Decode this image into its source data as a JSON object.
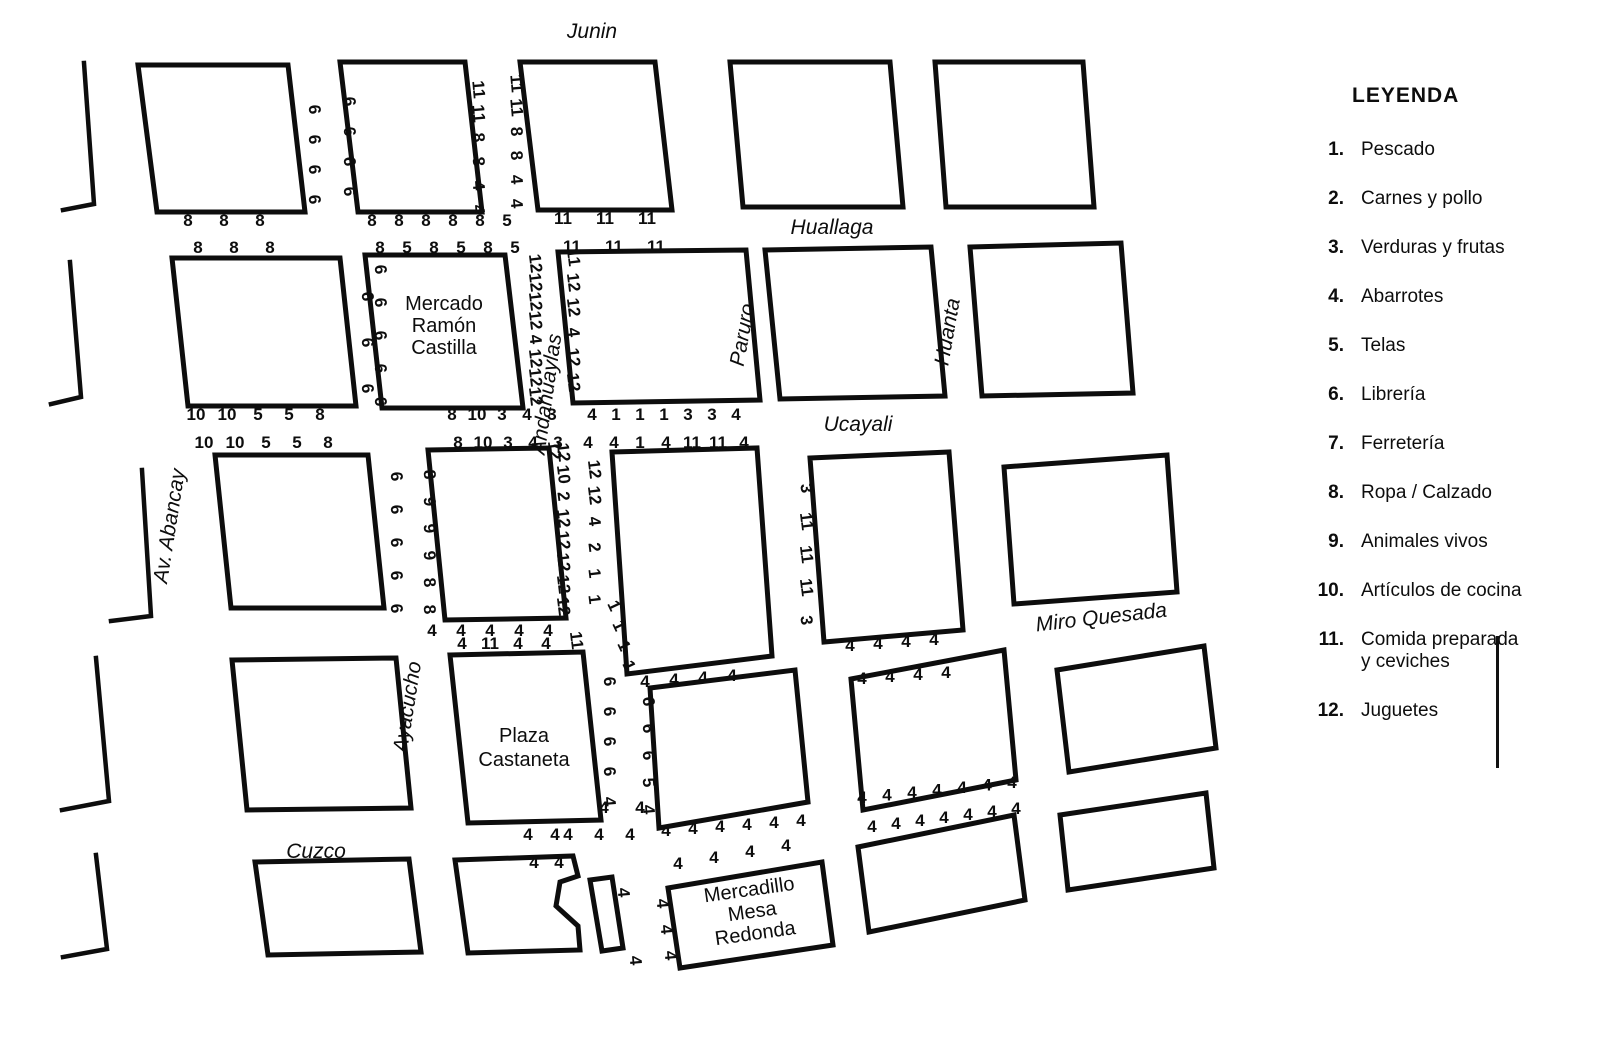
{
  "legend": {
    "title": "LEYENDA",
    "items": [
      {
        "num": "1.",
        "label": "Pescado"
      },
      {
        "num": "2.",
        "label": "Carnes y pollo"
      },
      {
        "num": "3.",
        "label": "Verduras y frutas"
      },
      {
        "num": "4.",
        "label": "Abarrotes"
      },
      {
        "num": "5.",
        "label": "Telas"
      },
      {
        "num": "6.",
        "label": "Librería"
      },
      {
        "num": "7.",
        "label": "Ferretería"
      },
      {
        "num": "8.",
        "label": "Ropa / Calzado"
      },
      {
        "num": "9.",
        "label": "Animales vivos"
      },
      {
        "num": "10.",
        "label": "Artículos de cocina"
      },
      {
        "num": "11.",
        "label": "Comida preparada\ny ceviches"
      },
      {
        "num": "12.",
        "label": "Juguetes"
      }
    ]
  },
  "map": {
    "street_labels": [
      {
        "name": "street-junin",
        "text": "Junin",
        "x": 592,
        "y": 38,
        "rot": 0
      },
      {
        "name": "street-huallaga",
        "text": "Huallaga",
        "x": 832,
        "y": 234,
        "rot": 0
      },
      {
        "name": "street-ucayali",
        "text": "Ucayali",
        "x": 858,
        "y": 431,
        "rot": 0
      },
      {
        "name": "street-miro-quesada",
        "text": "Miro Quesada",
        "x": 1102,
        "y": 624,
        "rot": -6.5
      },
      {
        "name": "street-cuzco",
        "text": "Cuzco",
        "x": 316,
        "y": 858,
        "rot": 0
      },
      {
        "name": "street-av-abancay",
        "text": "Av.  Abancay",
        "x": 176,
        "y": 527,
        "rot": -81
      },
      {
        "name": "street-ayacucho",
        "text": "Ayacucho",
        "x": 414,
        "y": 708,
        "rot": -81
      },
      {
        "name": "street-andahuaylas",
        "text": "Andahuaylas",
        "x": 553,
        "y": 395,
        "rot": -82
      },
      {
        "name": "street-paruro",
        "text": "Paruro",
        "x": 749,
        "y": 336,
        "rot": -80
      },
      {
        "name": "street-huanta",
        "text": "Huanta",
        "x": 954,
        "y": 333,
        "rot": -80
      }
    ],
    "block_labels": [
      {
        "name": "label-mercado-ramon-castilla",
        "lines": [
          "Mercado",
          "Ramón",
          "Castilla"
        ],
        "x": 444,
        "y": 310,
        "lh": 22,
        "rot": 0
      },
      {
        "name": "label-plaza-castaneta",
        "lines": [
          "Plaza",
          "Castaneta"
        ],
        "x": 524,
        "y": 742,
        "lh": 24,
        "rot": 0
      },
      {
        "name": "label-mercadillo-mesa-redonda",
        "lines": [
          "Mercadillo",
          "Mesa",
          "Redonda"
        ],
        "x": 750,
        "y": 896,
        "lh": 22,
        "rot": -8
      }
    ],
    "blocks": [
      {
        "name": "block-r1c1",
        "points": "138,65 288,65 305,212 157,212"
      },
      {
        "name": "block-r1c2",
        "points": "340,62 465,62 482,212 358,212"
      },
      {
        "name": "block-r1c3",
        "points": "520,62 655,62 672,210 538,210"
      },
      {
        "name": "block-r1c4",
        "points": "730,62 890,62 903,207 743,207"
      },
      {
        "name": "block-r1c5",
        "points": "935,62 1083,62 1094,207 946,207"
      },
      {
        "name": "block-r2c1",
        "points": "172,258 340,258 356,406 188,406"
      },
      {
        "name": "block-mercado-ramon-castilla",
        "points": "365,255 505,255 523,408 382,408"
      },
      {
        "name": "block-r2c3",
        "points": "558,252 746,250 760,400 573,403"
      },
      {
        "name": "block-r2c4",
        "points": "765,250 931,247 945,396 780,399"
      },
      {
        "name": "block-r2c5",
        "points": "970,247 1121,243 1133,393 982,396"
      },
      {
        "name": "block-r3c1",
        "points": "215,455 368,455 384,608 231,608"
      },
      {
        "name": "block-r3c2",
        "points": "428,450 549,448 566,618 445,620"
      },
      {
        "name": "block-r3c3",
        "points": "612,452 757,448 772,656 627,674"
      },
      {
        "name": "block-r3c4",
        "points": "810,458 949,452 963,630 824,642"
      },
      {
        "name": "block-r3c5",
        "points": "1004,467 1167,455 1177,592 1014,604"
      },
      {
        "name": "block-r4c1",
        "points": "232,660 396,658 411,808 247,810"
      },
      {
        "name": "block-plaza-castaneta",
        "points": "450,655 583,652 601,820 468,823"
      },
      {
        "name": "block-r4c3",
        "points": "650,688 795,670 808,802 659,828"
      },
      {
        "name": "block-r4c4",
        "points": "851,679 1004,650 1016,780 863,810"
      },
      {
        "name": "block-r4c5",
        "points": "1057,670 1204,646 1216,748 1069,772"
      },
      {
        "name": "block-r5c1",
        "points": "255,862 409,859 421,952 268,955"
      },
      {
        "name": "block-r5c2-notched",
        "points": "455,860 573,856 578,876 560,882 556,906 578,926 580,950 468,953"
      },
      {
        "name": "block-sliver",
        "points": "590,880 612,877 623,948 602,951"
      },
      {
        "name": "block-mercadillo-mesa-redonda",
        "points": "668,888 822,862 833,945 680,968"
      },
      {
        "name": "block-r5c4",
        "points": "858,847 1014,815 1025,900 869,932"
      },
      {
        "name": "block-r5c5",
        "points": "1060,815 1206,793 1214,868 1068,890"
      }
    ],
    "edge_lines": [
      {
        "name": "edge-r1-left",
        "d": "M 84,63 L 94,204 L 63,210"
      },
      {
        "name": "edge-r2-left",
        "d": "M 70,262 L 81,397 L 51,404"
      },
      {
        "name": "edge-r3-left",
        "d": "M 142,470 L 151,616 L 111,621"
      },
      {
        "name": "edge-r4-left",
        "d": "M 96,658 L 109,801 L 62,810"
      },
      {
        "name": "edge-r5-left",
        "d": "M 96,855 L 107,949 L 63,957"
      }
    ],
    "stalls": [
      {
        "values": [
          "8",
          "8",
          "8"
        ],
        "x": 188,
        "y": 226,
        "dx": 36
      },
      {
        "values": [
          "8",
          "8",
          "8"
        ],
        "x": 198,
        "y": 253,
        "dx": 36
      },
      {
        "values": [
          "8",
          "8",
          "8",
          "8",
          "8",
          "5"
        ],
        "x": 372,
        "y": 226,
        "dx": 27
      },
      {
        "values": [
          "8",
          "5",
          "8",
          "5",
          "8",
          "5"
        ],
        "x": 380,
        "y": 253,
        "dx": 27
      },
      {
        "values": [
          "11",
          "11",
          "11"
        ],
        "x": 563,
        "y": 224,
        "dx": 42
      },
      {
        "values": [
          "11",
          "11",
          "11"
        ],
        "x": 572,
        "y": 252,
        "dx": 42
      },
      {
        "values": [
          "10",
          "10",
          "5",
          "5",
          "8"
        ],
        "x": 196,
        "y": 420,
        "dx": 31
      },
      {
        "values": [
          "10",
          "10",
          "5",
          "5",
          "8"
        ],
        "x": 204,
        "y": 448,
        "dx": 31
      },
      {
        "values": [
          "8",
          "10",
          "3",
          "4",
          "3"
        ],
        "x": 452,
        "y": 420,
        "dx": 25
      },
      {
        "values": [
          "8",
          "10",
          "3",
          "4",
          "3"
        ],
        "x": 458,
        "y": 448,
        "dx": 25
      },
      {
        "values": [
          "4",
          "1",
          "1",
          "1",
          "3",
          "3",
          "4"
        ],
        "x": 592,
        "y": 420,
        "dx": 24
      },
      {
        "values": [
          "4",
          "4",
          "1",
          "4",
          "11",
          "11",
          "4"
        ],
        "x": 588,
        "y": 448,
        "dx": 26
      },
      {
        "values": [
          "4",
          "4",
          "4",
          "4",
          "4"
        ],
        "x": 432,
        "y": 636,
        "dx": 29
      },
      {
        "values": [
          "4",
          "11",
          "4",
          "4"
        ],
        "x": 462,
        "y": 649,
        "dx": 28
      },
      {
        "values": [
          "4",
          "4",
          "4",
          "4"
        ],
        "x": 645,
        "y": 687,
        "dx": 29,
        "dy": -2
      },
      {
        "values": [
          "4",
          "4",
          "4",
          "4"
        ],
        "x": 850,
        "y": 651,
        "dx": 28,
        "dy": -2
      },
      {
        "values": [
          "4",
          "4",
          "4",
          "4"
        ],
        "x": 862,
        "y": 684,
        "dx": 28,
        "dy": -2
      },
      {
        "values": [
          "4",
          "4",
          "4",
          "4",
          "4",
          "4",
          "4"
        ],
        "x": 862,
        "y": 803,
        "dx": 25,
        "dy": -2.5
      },
      {
        "values": [
          "4",
          "4",
          "4",
          "4",
          "4",
          "4",
          "4"
        ],
        "x": 872,
        "y": 832,
        "dx": 24,
        "dy": -3
      },
      {
        "values": [
          "4",
          "4",
          "4",
          "4",
          "4",
          "4"
        ],
        "x": 666,
        "y": 836,
        "dx": 27,
        "dy": -2
      },
      {
        "values": [
          "4",
          "4",
          "4",
          "4"
        ],
        "x": 678,
        "y": 869,
        "dx": 36,
        "dy": -6
      },
      {
        "values": [
          "4",
          "4"
        ],
        "x": 528,
        "y": 840,
        "dx": 27
      },
      {
        "values": [
          "4",
          "4",
          "4"
        ],
        "x": 568,
        "y": 840,
        "dx": 31
      },
      {
        "values": [
          "4",
          "4"
        ],
        "x": 534,
        "y": 868,
        "dx": 25
      },
      {
        "values": [
          "4",
          "4"
        ],
        "x": 604,
        "y": 813,
        "dx": 36
      },
      {
        "values": [
          "6",
          "6",
          "6",
          "6"
        ],
        "x": 309,
        "y": 110,
        "dy": 30,
        "rot": 85
      },
      {
        "values": [
          "6",
          "6",
          "6",
          "6"
        ],
        "x": 344,
        "y": 102,
        "dy": 30,
        "rot": 85
      },
      {
        "values": [
          "11",
          "11",
          "8",
          "8",
          "4",
          "4"
        ],
        "x": 473,
        "y": 90,
        "dy": 24,
        "rot": 85
      },
      {
        "values": [
          "11",
          "11",
          "8",
          "8",
          "4",
          "4"
        ],
        "x": 511,
        "y": 84,
        "dy": 24,
        "rot": 85
      },
      {
        "values": [
          "6",
          "6",
          "6"
        ],
        "x": 362,
        "y": 297,
        "dy": 46,
        "rot": 85
      },
      {
        "values": [
          "6",
          "6",
          "6",
          "6",
          "6"
        ],
        "x": 375,
        "y": 270,
        "dy": 33,
        "rot": 85
      },
      {
        "values": [
          "12",
          "12",
          "12",
          "12",
          "4",
          "12",
          "12",
          "12"
        ],
        "x": 530,
        "y": 264,
        "dy": 19,
        "rot": 83
      },
      {
        "values": [
          "11",
          "12",
          "12",
          "4",
          "12",
          "12"
        ],
        "x": 568,
        "y": 258,
        "dy": 25,
        "rot": 83
      },
      {
        "values": [
          "6",
          "6",
          "6",
          "6",
          "6"
        ],
        "x": 391,
        "y": 477,
        "dy": 33,
        "rot": 85
      },
      {
        "values": [
          "8",
          "9",
          "9",
          "9",
          "8",
          "8"
        ],
        "x": 424,
        "y": 475,
        "dy": 27,
        "rot": 85
      },
      {
        "values": [
          "12",
          "10",
          "2",
          "12",
          "12",
          "12",
          "12",
          "12"
        ],
        "x": 558,
        "y": 453,
        "dy": 22,
        "rot": 83
      },
      {
        "values": [
          "12",
          "12",
          "4",
          "2",
          "1",
          "1"
        ],
        "x": 589,
        "y": 470,
        "dy": 26,
        "rot": 83
      },
      {
        "values": [
          "11"
        ],
        "x": 571,
        "y": 641,
        "rot": 83
      },
      {
        "values": [
          "1",
          "1",
          "1",
          "1"
        ],
        "x": 609,
        "y": 608,
        "dx": 5,
        "dy": 20,
        "rot": 65
      },
      {
        "values": [
          "3",
          "11",
          "11",
          "11",
          "3"
        ],
        "x": 801,
        "y": 489,
        "dy": 33,
        "rot": 83
      },
      {
        "values": [
          "6",
          "6",
          "6",
          "6",
          "4"
        ],
        "x": 604,
        "y": 682,
        "dy": 30,
        "rot": 85
      },
      {
        "values": [
          "6",
          "6",
          "6",
          "5",
          "4"
        ],
        "x": 643,
        "y": 702,
        "dy": 27,
        "rot": 85
      },
      {
        "values": [
          "4",
          "4",
          "4"
        ],
        "x": 657,
        "y": 904,
        "dx": 4,
        "dy": 26,
        "rot": 85
      },
      {
        "values": [
          "4"
        ],
        "x": 618,
        "y": 893,
        "rot": 85
      },
      {
        "values": [
          "4"
        ],
        "x": 630,
        "y": 961,
        "rot": 85
      },
      {
        "values": [
          "12"
        ],
        "x": 549,
        "y": 451,
        "rot": 83
      }
    ]
  }
}
